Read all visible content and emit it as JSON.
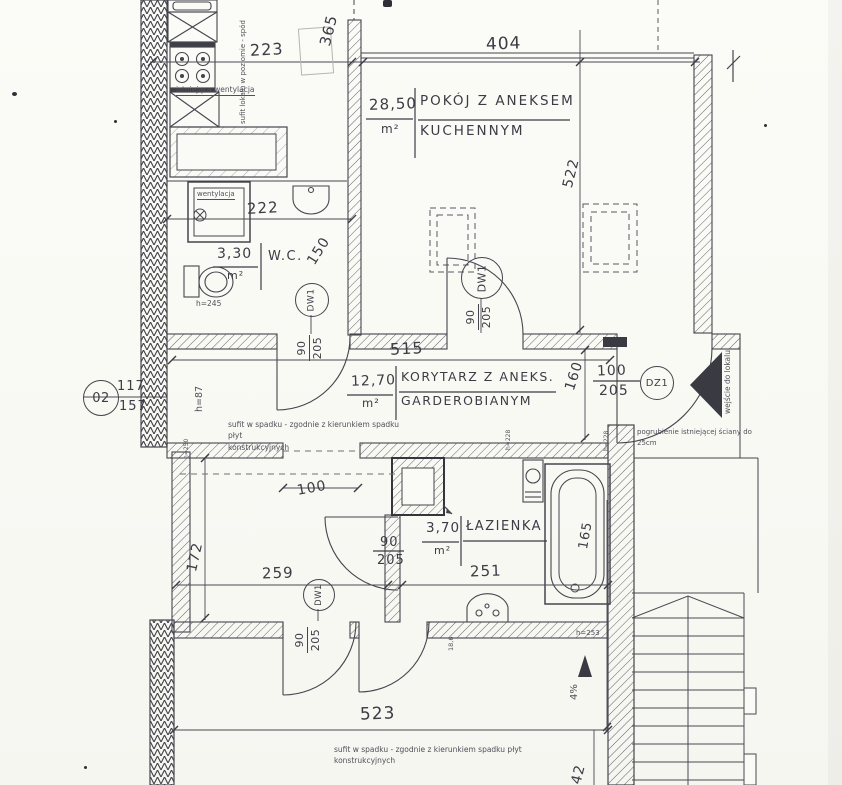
{
  "colors": {
    "paper": "#fafaf6",
    "ink": "#45454e"
  },
  "rooms": {
    "main": {
      "area": "28,50",
      "unit": "m²",
      "name1": "POKÓJ Z ANEKSEM",
      "name2": "KUCHENNYM"
    },
    "wc": {
      "area": "3,30",
      "unit": "m²",
      "name": "W.C."
    },
    "corridor": {
      "area": "12,70",
      "unit": "m²",
      "name1": "KORYTARZ Z ANEKS.",
      "name2": "GARDEROBIANYM"
    },
    "bath": {
      "area": "3,70",
      "unit": "m²",
      "name": "ŁAZIENKA"
    }
  },
  "dims": {
    "d223": "223",
    "d404": "404",
    "d365": "365",
    "d522": "522",
    "d222": "222",
    "d150": "150",
    "d515": "515",
    "d160": "160",
    "d100": "100",
    "d172": "172",
    "d259": "259",
    "d251": "251",
    "d165": "165",
    "d523": "523",
    "d542": "542",
    "d186": "18,6",
    "slope": "4%"
  },
  "doors": {
    "dw1": "DW1",
    "dz1": "DZ1",
    "w90": "90",
    "w100": "100",
    "h205": "205"
  },
  "marker": {
    "circle": "02",
    "num": "117",
    "den": "157"
  },
  "heights": {
    "h87": "h=87",
    "h245": "h=245",
    "h250": "h=250",
    "h253": "h=253",
    "h228": "h=228"
  },
  "notes": {
    "vent_existing": "istniejąca wentylacja",
    "vent": "wentylacja",
    "entry": "wejście do lokalu",
    "thicken1": "pogrubienie istniejącej ściany do",
    "thicken2": "25cm",
    "slope1": "sufit w spadku - zgodnie z kierunkiem spadku płyt",
    "slope2": "konstrukcyjnych",
    "level": "sufit lokalu w poziomie - spód"
  }
}
